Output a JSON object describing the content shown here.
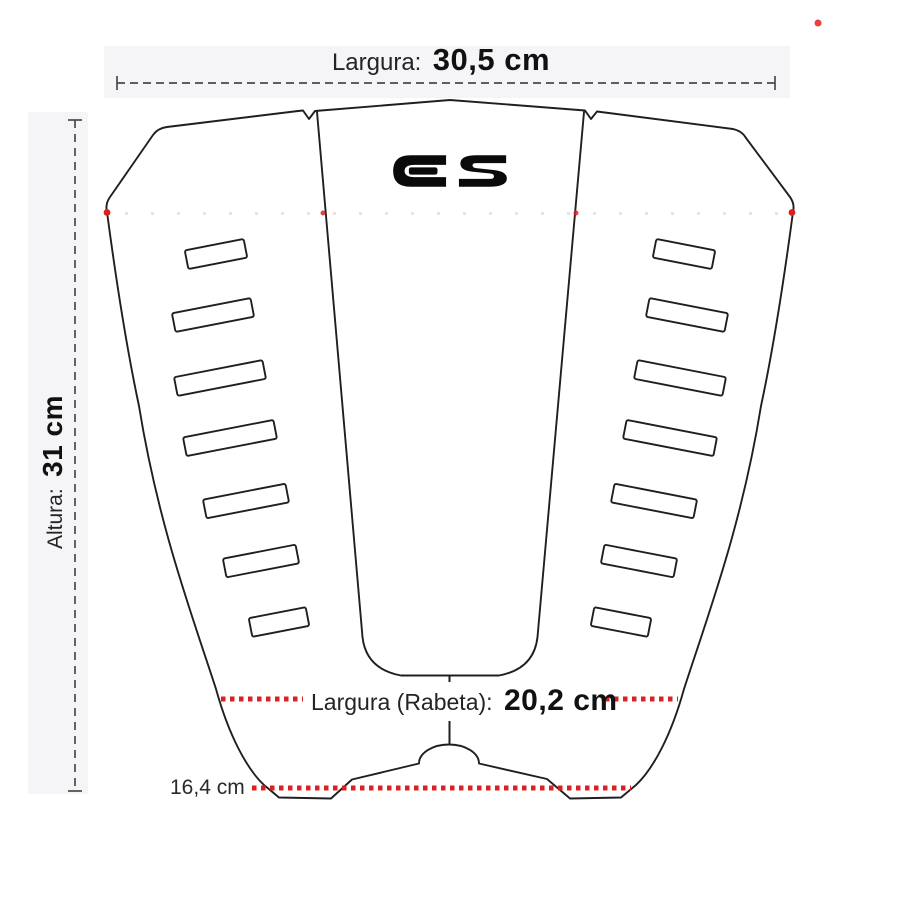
{
  "logo": {
    "text": "ES"
  },
  "dimensions": {
    "width": {
      "label": "Largura:",
      "value": "30,5 cm"
    },
    "height": {
      "label": "Altura:",
      "value": "31 cm"
    },
    "tail_width": {
      "label": "Largura (Rabeta):",
      "value": "20,2 cm"
    },
    "rear_width": {
      "value": "16,4 cm"
    }
  },
  "colors": {
    "outline": "#1f1f1f",
    "dimension_line": "#4a4a4a",
    "measure_red": "#d92121",
    "faint_red": "#efc3c3"
  },
  "diagram": {
    "subject": "surf traction pad, 3 pieces, slanted grooves",
    "groove_count_left": 7,
    "groove_count_right": 7
  }
}
